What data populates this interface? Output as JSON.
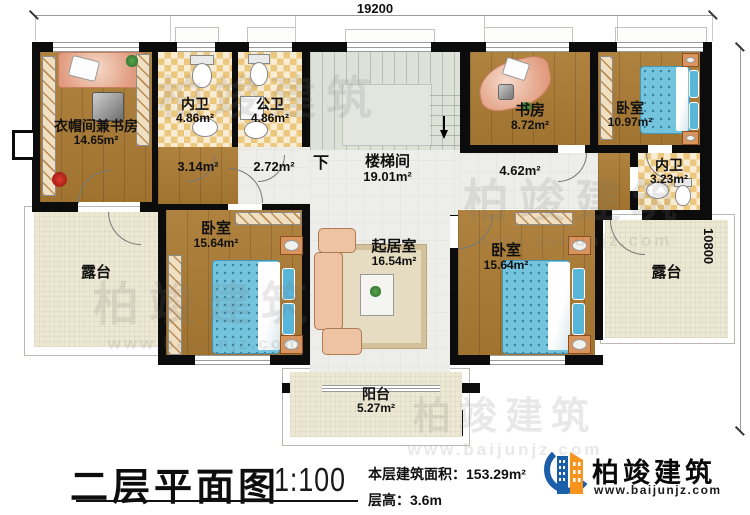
{
  "dimensions": {
    "width": "19200",
    "height": "10800"
  },
  "rooms": {
    "cloak_study": {
      "name": "衣帽间兼书房",
      "area": "14.65m²"
    },
    "inner_bath1": {
      "name": "内卫",
      "area": "4.86m²"
    },
    "public_bath": {
      "name": "公卫",
      "area": "4.86m²"
    },
    "hall_1": {
      "area": "3.14m²"
    },
    "hall_2": {
      "area": "2.72m²"
    },
    "stairwell": {
      "name": "楼梯间",
      "area": "19.01m²",
      "down": "下"
    },
    "study": {
      "name": "书房",
      "area": "8.72m²"
    },
    "bedroom_ne": {
      "name": "卧室",
      "area": "10.97m²"
    },
    "inner_bath2": {
      "name": "内卫",
      "area": "3.23m²"
    },
    "hall_3": {
      "area": "4.62m²"
    },
    "bedroom_w": {
      "name": "卧室",
      "area": "15.64m²"
    },
    "living": {
      "name": "起居室",
      "area": "16.54m²"
    },
    "bedroom_e": {
      "name": "卧室",
      "area": "15.64m²"
    },
    "terrace_w": {
      "name": "露台"
    },
    "terrace_e": {
      "name": "露台"
    },
    "balcony": {
      "name": "阳台",
      "area": "5.27m²"
    }
  },
  "title": {
    "main": "二层平面图",
    "scale": "1:100",
    "area_label": "本层建筑面积：",
    "area_value": "153.29m²",
    "height_label": "层高：",
    "height_value": "3.6m"
  },
  "logo": {
    "name": "柏竣建筑",
    "url": "www.baijunjz.com"
  },
  "watermark": {
    "text": "柏竣建筑",
    "url": "www.baijunjz.com"
  }
}
